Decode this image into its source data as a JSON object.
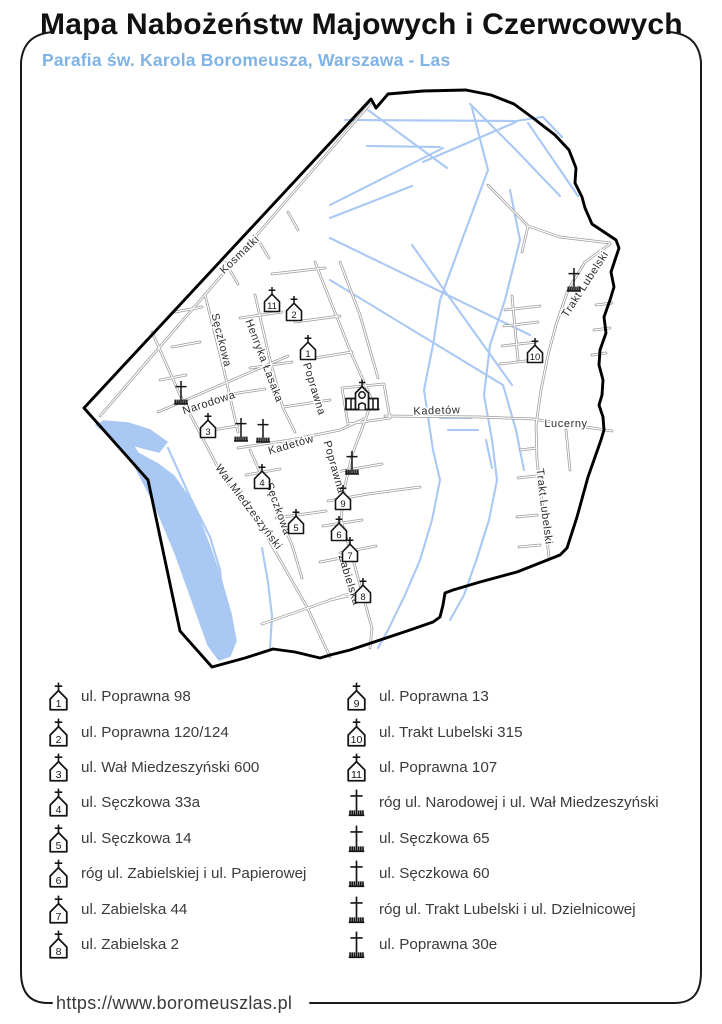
{
  "header": {
    "title": "Mapa Nabożeństw Majowych i Czerwcowych",
    "subtitle": "Parafia św. Karola Boromeusza, Warszawa - Las"
  },
  "footer": {
    "url": "https://www.boromeuszlas.pl"
  },
  "legend": {
    "left": [
      {
        "icon": "chapel",
        "num": "1",
        "label": "ul. Poprawna 98"
      },
      {
        "icon": "chapel",
        "num": "2",
        "label": "ul. Poprawna 120/124"
      },
      {
        "icon": "chapel",
        "num": "3",
        "label": "ul. Wał Miedzeszyński 600"
      },
      {
        "icon": "chapel",
        "num": "4",
        "label": "ul. Sęczkowa 33a"
      },
      {
        "icon": "chapel",
        "num": "5",
        "label": "ul. Sęczkowa 14"
      },
      {
        "icon": "chapel",
        "num": "6",
        "label": "róg ul. Zabielskiej i ul. Papierowej"
      },
      {
        "icon": "chapel",
        "num": "7",
        "label": "ul. Zabielska 44"
      },
      {
        "icon": "chapel",
        "num": "8",
        "label": "ul. Zabielska 2"
      }
    ],
    "right": [
      {
        "icon": "chapel",
        "num": "9",
        "label": "ul. Poprawna 13"
      },
      {
        "icon": "chapel",
        "num": "10",
        "label": "ul. Trakt Lubelski 315"
      },
      {
        "icon": "chapel",
        "num": "11",
        "label": "ul. Poprawna 107"
      },
      {
        "icon": "cross",
        "label": "róg ul. Narodowej i ul. Wał Miedzeszyński"
      },
      {
        "icon": "cross",
        "label": "ul. Sęczkowa 65"
      },
      {
        "icon": "cross",
        "label": "ul. Sęczkowa 60"
      },
      {
        "icon": "cross",
        "label": "róg ul. Trakt Lubelski i ul. Dzielnicowej"
      },
      {
        "icon": "cross",
        "label": "ul. Poprawna 30e"
      }
    ]
  },
  "map": {
    "colors": {
      "water": "#a9c8f3",
      "street": "#9b9b9b",
      "boundary": "#000000",
      "label": "#2d2d2d",
      "icon": "#141414"
    },
    "boundary": [
      [
        84,
        408
      ],
      [
        371,
        99
      ],
      [
        376,
        108
      ],
      [
        388,
        94
      ],
      [
        423,
        91
      ],
      [
        466,
        90
      ],
      [
        491,
        95
      ],
      [
        514,
        104
      ],
      [
        533,
        118
      ],
      [
        555,
        135
      ],
      [
        569,
        150
      ],
      [
        576,
        168
      ],
      [
        575,
        183
      ],
      [
        582,
        197
      ],
      [
        585,
        208
      ],
      [
        592,
        224
      ],
      [
        616,
        240
      ],
      [
        619,
        248
      ],
      [
        615,
        260
      ],
      [
        611,
        272
      ],
      [
        614,
        287
      ],
      [
        610,
        300
      ],
      [
        604,
        317
      ],
      [
        606,
        333
      ],
      [
        600,
        350
      ],
      [
        599,
        365
      ],
      [
        603,
        380
      ],
      [
        602,
        395
      ],
      [
        599,
        405
      ],
      [
        603,
        417
      ],
      [
        604,
        430
      ],
      [
        601,
        440
      ],
      [
        588,
        477
      ],
      [
        577,
        517
      ],
      [
        567,
        548
      ],
      [
        560,
        555
      ],
      [
        517,
        572
      ],
      [
        480,
        582
      ],
      [
        453,
        590
      ],
      [
        445,
        593
      ],
      [
        443,
        605
      ],
      [
        440,
        617
      ],
      [
        433,
        622
      ],
      [
        410,
        630
      ],
      [
        380,
        640
      ],
      [
        350,
        650
      ],
      [
        330,
        655
      ],
      [
        320,
        658
      ],
      [
        295,
        652
      ],
      [
        273,
        649
      ],
      [
        245,
        658
      ],
      [
        212,
        667
      ],
      [
        180,
        631
      ],
      [
        148,
        480
      ]
    ],
    "river": [
      [
        104,
        421
      ],
      [
        128,
        423
      ],
      [
        150,
        430
      ],
      [
        167,
        442
      ],
      [
        159,
        452
      ],
      [
        143,
        448
      ],
      [
        133,
        445
      ],
      [
        138,
        453
      ],
      [
        158,
        464
      ],
      [
        174,
        476
      ],
      [
        188,
        496
      ],
      [
        199,
        518
      ],
      [
        210,
        547
      ],
      [
        221,
        579
      ],
      [
        231,
        614
      ],
      [
        236,
        641
      ],
      [
        230,
        656
      ],
      [
        219,
        660
      ],
      [
        208,
        645
      ],
      [
        193,
        603
      ],
      [
        175,
        553
      ],
      [
        154,
        503
      ],
      [
        131,
        459
      ],
      [
        110,
        436
      ],
      [
        96,
        425
      ]
    ],
    "channels": [
      [
        [
          345,
          120
        ],
        [
          516,
          121
        ]
      ],
      [
        [
          423,
          162
        ],
        [
          516,
          122
        ]
      ],
      [
        [
          330,
          205
        ],
        [
          443,
          148
        ]
      ],
      [
        [
          330,
          218
        ],
        [
          412,
          186
        ]
      ],
      [
        [
          368,
          110
        ],
        [
          447,
          168
        ]
      ],
      [
        [
          470,
          104
        ],
        [
          516,
          150
        ],
        [
          560,
          196
        ]
      ],
      [
        [
          528,
          123
        ],
        [
          578,
          196
        ]
      ],
      [
        [
          516,
          121
        ],
        [
          543,
          117
        ],
        [
          562,
          137
        ]
      ],
      [
        [
          330,
          238
        ],
        [
          530,
          335
        ]
      ],
      [
        [
          330,
          280
        ],
        [
          503,
          385
        ]
      ],
      [
        [
          412,
          245
        ],
        [
          512,
          385
        ]
      ],
      [
        [
          472,
          108
        ],
        [
          488,
          170
        ],
        [
          462,
          240
        ],
        [
          440,
          300
        ],
        [
          433,
          345
        ],
        [
          424,
          390
        ],
        [
          433,
          450
        ],
        [
          440,
          480
        ],
        [
          432,
          520
        ],
        [
          420,
          560
        ],
        [
          405,
          595
        ],
        [
          388,
          630
        ],
        [
          378,
          648
        ]
      ],
      [
        [
          510,
          190
        ],
        [
          520,
          240
        ],
        [
          505,
          300
        ],
        [
          490,
          345
        ],
        [
          484,
          395
        ],
        [
          492,
          440
        ],
        [
          497,
          480
        ],
        [
          489,
          520
        ],
        [
          477,
          558
        ],
        [
          464,
          595
        ],
        [
          450,
          620
        ]
      ],
      [
        [
          440,
          418
        ],
        [
          472,
          418
        ]
      ],
      [
        [
          448,
          430
        ],
        [
          478,
          430
        ]
      ],
      [
        [
          503,
          385
        ],
        [
          516,
          430
        ],
        [
          524,
          470
        ]
      ],
      [
        [
          486,
          440
        ],
        [
          492,
          468
        ]
      ],
      [
        [
          367,
          146
        ],
        [
          440,
          147
        ]
      ],
      [
        [
          168,
          448
        ],
        [
          190,
          497
        ],
        [
          210,
          537
        ],
        [
          220,
          570
        ],
        [
          224,
          612
        ],
        [
          221,
          648
        ]
      ],
      [
        [
          262,
          548
        ],
        [
          268,
          582
        ],
        [
          272,
          616
        ],
        [
          270,
          648
        ]
      ]
    ],
    "streets": [
      [
        [
          100,
          416
        ],
        [
          370,
          104
        ]
      ],
      [
        [
          152,
          332
        ],
        [
          180,
          395
        ],
        [
          223,
          477
        ],
        [
          267,
          537
        ],
        [
          307,
          607
        ],
        [
          330,
          657
        ]
      ],
      [
        [
          158,
          412
        ],
        [
          288,
          356
        ]
      ],
      [
        [
          205,
          295
        ],
        [
          222,
          362
        ],
        [
          238,
          432
        ]
      ],
      [
        [
          250,
          450
        ],
        [
          275,
          505
        ],
        [
          292,
          545
        ],
        [
          302,
          578
        ]
      ],
      [
        [
          255,
          295
        ],
        [
          270,
          360
        ],
        [
          283,
          408
        ],
        [
          295,
          432
        ]
      ],
      [
        [
          315,
          262
        ],
        [
          332,
          305
        ],
        [
          352,
          355
        ],
        [
          372,
          400
        ],
        [
          366,
          418
        ],
        [
          352,
          455
        ],
        [
          344,
          490
        ],
        [
          341,
          520
        ]
      ],
      [
        [
          341,
          520
        ],
        [
          352,
          556
        ],
        [
          362,
          592
        ],
        [
          372,
          628
        ],
        [
          370,
          648
        ]
      ],
      [
        [
          238,
          448
        ],
        [
          290,
          440
        ],
        [
          340,
          430
        ],
        [
          366,
          418
        ]
      ],
      [
        [
          385,
          416
        ],
        [
          480,
          417
        ],
        [
          533,
          419
        ],
        [
          612,
          431
        ]
      ],
      [
        [
          610,
          244
        ],
        [
          585,
          262
        ],
        [
          568,
          290
        ],
        [
          556,
          325
        ],
        [
          548,
          355
        ],
        [
          541,
          390
        ],
        [
          536,
          425
        ],
        [
          537,
          460
        ],
        [
          541,
          495
        ],
        [
          546,
          530
        ],
        [
          549,
          558
        ]
      ],
      [
        [
          488,
          185
        ],
        [
          528,
          226
        ],
        [
          560,
          237
        ],
        [
          610,
          243
        ]
      ],
      [
        [
          528,
          226
        ],
        [
          522,
          252
        ]
      ],
      [
        [
          340,
          262
        ],
        [
          360,
          315
        ],
        [
          378,
          378
        ]
      ],
      [
        [
          342,
          388
        ],
        [
          384,
          384
        ],
        [
          390,
          418
        ],
        [
          348,
          424
        ],
        [
          342,
          388
        ]
      ],
      [
        [
          272,
          274
        ],
        [
          325,
          268
        ]
      ],
      [
        [
          295,
          322
        ],
        [
          340,
          316
        ]
      ],
      [
        [
          240,
          318
        ],
        [
          282,
          312
        ]
      ],
      [
        [
          308,
          359
        ],
        [
          352,
          352
        ]
      ],
      [
        [
          250,
          368
        ],
        [
          292,
          362
        ]
      ],
      [
        [
          283,
          407
        ],
        [
          330,
          400
        ]
      ],
      [
        [
          225,
          395
        ],
        [
          265,
          389
        ]
      ],
      [
        [
          212,
          430
        ],
        [
          238,
          426
        ]
      ],
      [
        [
          175,
          312
        ],
        [
          202,
          307
        ]
      ],
      [
        [
          172,
          347
        ],
        [
          200,
          342
        ]
      ],
      [
        [
          160,
          380
        ],
        [
          186,
          375
        ]
      ],
      [
        [
          225,
          262
        ],
        [
          238,
          284
        ]
      ],
      [
        [
          256,
          236
        ],
        [
          269,
          258
        ]
      ],
      [
        [
          288,
          212
        ],
        [
          298,
          230
        ]
      ],
      [
        [
          246,
          475
        ],
        [
          280,
          469
        ]
      ],
      [
        [
          276,
          518
        ],
        [
          326,
          511
        ]
      ],
      [
        [
          323,
          526
        ],
        [
          362,
          520
        ]
      ],
      [
        [
          340,
          553
        ],
        [
          376,
          546
        ]
      ],
      [
        [
          328,
          501
        ],
        [
          368,
          494
        ],
        [
          420,
          487
        ]
      ],
      [
        [
          336,
          472
        ],
        [
          382,
          464
        ]
      ],
      [
        [
          262,
          624
        ],
        [
          305,
          609
        ],
        [
          348,
          594
        ]
      ],
      [
        [
          320,
          562
        ],
        [
          352,
          556
        ]
      ],
      [
        [
          330,
          600
        ],
        [
          362,
          593
        ]
      ],
      [
        [
          505,
          310
        ],
        [
          540,
          306
        ]
      ],
      [
        [
          504,
          326
        ],
        [
          538,
          322
        ]
      ],
      [
        [
          502,
          346
        ],
        [
          536,
          342
        ]
      ],
      [
        [
          500,
          364
        ],
        [
          534,
          360
        ]
      ],
      [
        [
          512,
          296
        ],
        [
          518,
          360
        ]
      ],
      [
        [
          520,
          450
        ],
        [
          537,
          448
        ]
      ],
      [
        [
          518,
          478
        ],
        [
          536,
          476
        ]
      ],
      [
        [
          517,
          517
        ],
        [
          537,
          515
        ]
      ],
      [
        [
          519,
          547
        ],
        [
          540,
          545
        ]
      ],
      [
        [
          596,
          305
        ],
        [
          612,
          303
        ]
      ],
      [
        [
          594,
          330
        ],
        [
          610,
          328
        ]
      ],
      [
        [
          592,
          355
        ],
        [
          606,
          353
        ]
      ],
      [
        [
          566,
          430
        ],
        [
          570,
          470
        ]
      ]
    ],
    "street_labels": [
      {
        "text": "Kosmatki",
        "x": 242,
        "y": 257,
        "r": -44
      },
      {
        "text": "Sęczkowa",
        "x": 218,
        "y": 341,
        "r": 76
      },
      {
        "text": "Henryka Łasaka",
        "x": 261,
        "y": 362,
        "r": 69
      },
      {
        "text": "Poprawna",
        "x": 311,
        "y": 390,
        "r": 73
      },
      {
        "text": "Narodowa",
        "x": 210,
        "y": 406,
        "r": -18
      },
      {
        "text": "Kadetów",
        "x": 292,
        "y": 448,
        "r": -16
      },
      {
        "text": "Kadetów",
        "x": 437,
        "y": 414,
        "r": -2
      },
      {
        "text": "Lucerny",
        "x": 566,
        "y": 427,
        "r": 0
      },
      {
        "text": "Poprawna",
        "x": 331,
        "y": 468,
        "r": 74
      },
      {
        "text": "Sęczkowa",
        "x": 275,
        "y": 510,
        "r": 70
      },
      {
        "text": "Wał Miedzeszyński",
        "x": 246,
        "y": 509,
        "r": 53
      },
      {
        "text": "Zabielska",
        "x": 346,
        "y": 581,
        "r": 73
      },
      {
        "text": "Trakt Lubelski",
        "x": 588,
        "y": 286,
        "r": -57
      },
      {
        "text": "Trakt Lubelski",
        "x": 541,
        "y": 507,
        "r": 83
      }
    ],
    "chapels": [
      {
        "num": "1",
        "x": 308,
        "y": 349
      },
      {
        "num": "2",
        "x": 294,
        "y": 310
      },
      {
        "num": "3",
        "x": 208,
        "y": 427
      },
      {
        "num": "4",
        "x": 262,
        "y": 478
      },
      {
        "num": "5",
        "x": 296,
        "y": 523
      },
      {
        "num": "6",
        "x": 339,
        "y": 530
      },
      {
        "num": "7",
        "x": 350,
        "y": 551
      },
      {
        "num": "8",
        "x": 363,
        "y": 592
      },
      {
        "num": "9",
        "x": 343,
        "y": 499
      },
      {
        "num": "10",
        "x": 535,
        "y": 352
      },
      {
        "num": "11",
        "x": 272,
        "y": 301
      }
    ],
    "crosses": [
      {
        "x": 181,
        "y": 394
      },
      {
        "x": 241,
        "y": 431
      },
      {
        "x": 263,
        "y": 432
      },
      {
        "x": 574,
        "y": 281
      },
      {
        "x": 352,
        "y": 464
      }
    ],
    "church": {
      "x": 362,
      "y": 400
    }
  }
}
